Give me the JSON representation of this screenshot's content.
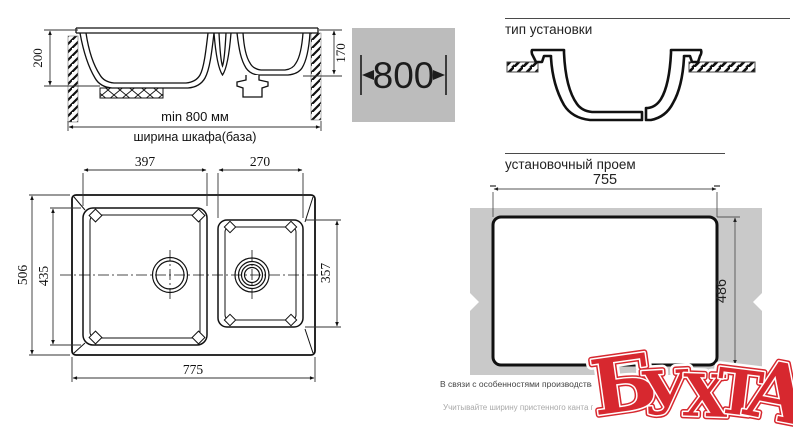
{
  "front_view": {
    "depth_main": "200",
    "depth_second": "170",
    "min_width_label": "min 800 мм",
    "cabinet_label": "ширина шкафа(база)"
  },
  "badge": {
    "width": "800"
  },
  "installation": {
    "title": "тип установки"
  },
  "top_view": {
    "bowl1_width": "397",
    "bowl2_width": "270",
    "overall_depth": "506",
    "bowl1_depth": "435",
    "bowl2_depth": "357",
    "overall_width": "775"
  },
  "cutout": {
    "title": "установочный проем",
    "width": "755",
    "depth": "486"
  },
  "notes": {
    "production": "В связи с особенностями производства вырез в с",
    "wall_trim": "Учитывайте ширину пристенного канта при ус"
  },
  "logo": {
    "text": "БУХТА",
    "letters": [
      "Б",
      "У",
      "Х",
      "Т",
      "А"
    ],
    "color": "#d7282f"
  },
  "colors": {
    "badge_bg": "#bcbcbc",
    "countertop_fill": "#c9c9c9",
    "line": "#111111"
  }
}
